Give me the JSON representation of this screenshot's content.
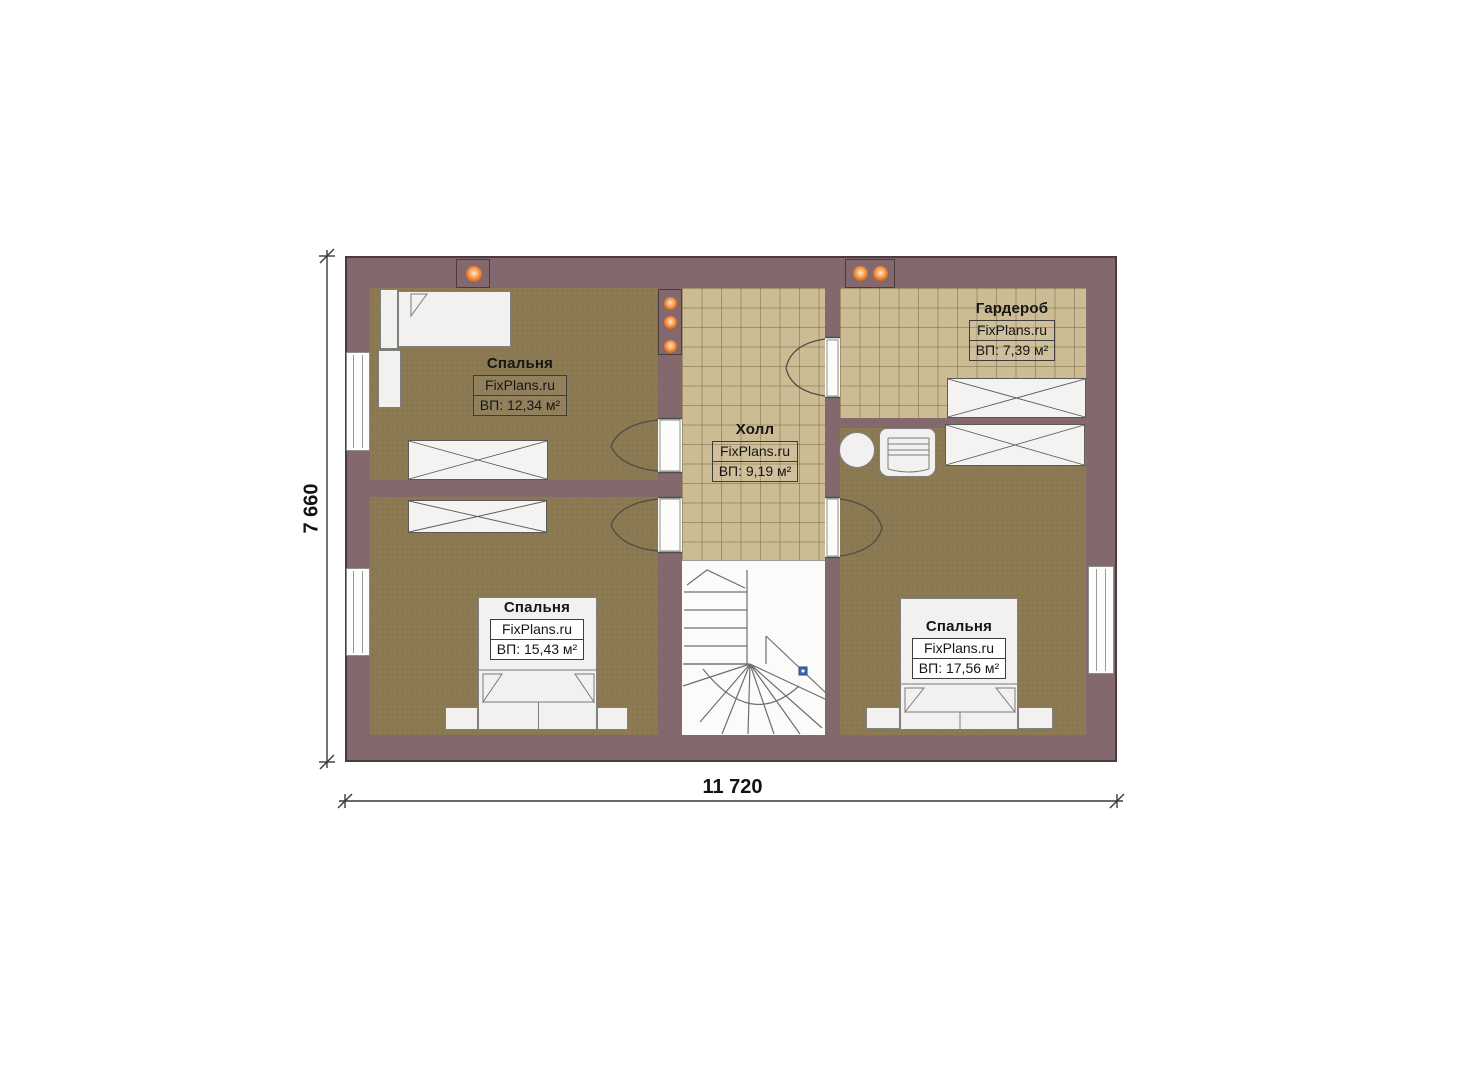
{
  "plan": {
    "type": "floor-plan",
    "brand": "FixPlans.ru",
    "dimensions": {
      "width_label": "11 720",
      "height_label": "7 660"
    },
    "rooms": [
      {
        "id": "bedroom-top-left",
        "title": "Спальня",
        "brand": "FixPlans.ru",
        "area": "ВП: 12,34 м²"
      },
      {
        "id": "hall",
        "title": "Холл",
        "brand": "FixPlans.ru",
        "area": "ВП: 9,19 м²"
      },
      {
        "id": "wardrobe",
        "title": "Гардероб",
        "brand": "FixPlans.ru",
        "area": "ВП: 7,39 м²"
      },
      {
        "id": "bedroom-bottom-left",
        "title": "Спальня",
        "brand": "FixPlans.ru",
        "area": "ВП: 15,43 м²"
      },
      {
        "id": "bedroom-bottom-right",
        "title": "Спальня",
        "brand": "FixPlans.ru",
        "area": "ВП: 17,56 м²"
      }
    ],
    "colors": {
      "wall": "#83696e",
      "carpet_floor": "#8c7a53",
      "tile_floor": "#ccbc94",
      "light_accent": "#e06a1d",
      "stair_marker_blue": "#4066b4"
    }
  }
}
